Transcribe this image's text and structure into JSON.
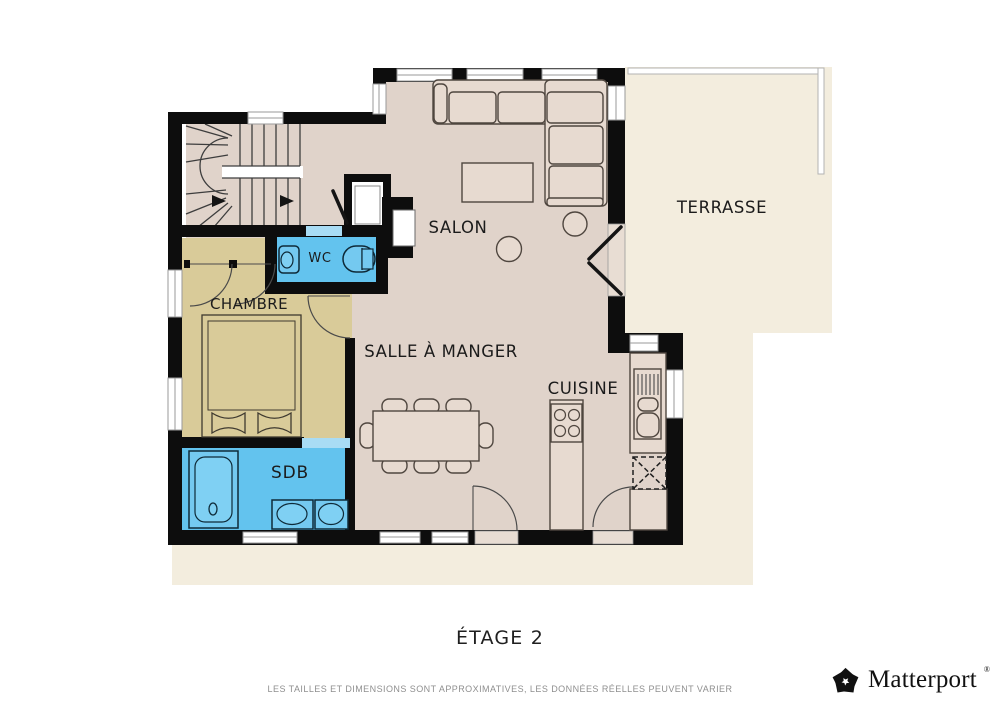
{
  "page": {
    "floor_label": "ÉTAGE 2",
    "disclaimer": "LES TAILLES ET DIMENSIONS SONT APPROXIMATIVES, LES DONNÉES RÉELLES PEUVENT VARIER"
  },
  "brand": {
    "name": "Matterport",
    "registered_mark": "®"
  },
  "rooms": {
    "salon": "SALON",
    "terrasse": "TERRASSE",
    "wc": "WC",
    "chambre": "CHAMBRE",
    "salle_a_manger": "SALLE À MANGER",
    "cuisine": "CUISINE",
    "sdb": "SDB"
  },
  "colors": {
    "wall": "#0d0d0d",
    "floor": "#e0d3ca",
    "bedroom_floor": "#d9cb99",
    "bathroom_floor": "#63c3ee",
    "door_highlight": "#a9dcf4",
    "terrace_floor": "#f3edde",
    "furniture_fill": "#e7dad0",
    "furniture_outline": "#4f463f",
    "background": "#ffffff",
    "label_text": "#1b1b1b",
    "disclaimer_text": "#8f8f8f",
    "brand_text": "#111111"
  }
}
